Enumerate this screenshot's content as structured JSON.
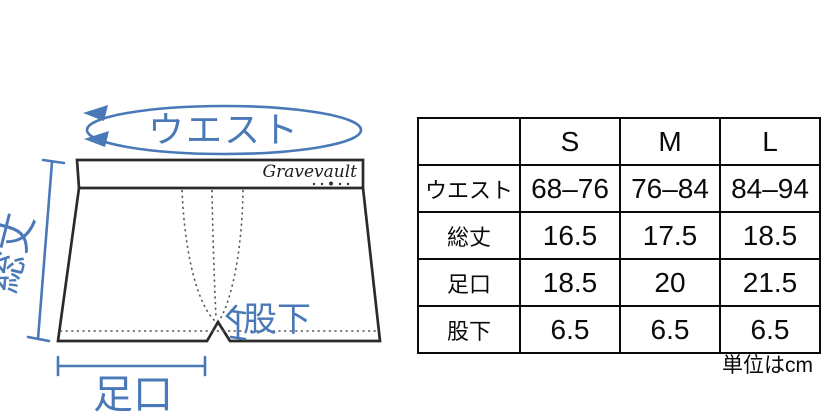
{
  "diagram": {
    "waist_label": "ウエスト",
    "total_length_label": "総丈",
    "leg_opening_label": "足口",
    "inseam_label": "股下",
    "brand_logo_text": "Gravevault",
    "accent_color": "#4a79b8",
    "outline_color": "#2b2b2b"
  },
  "size_table": {
    "columns": [
      "",
      "S",
      "M",
      "L"
    ],
    "rows": [
      {
        "label": "ウエスト",
        "values": [
          "68–76",
          "76–84",
          "84–94"
        ]
      },
      {
        "label": "総丈",
        "values": [
          "16.5",
          "17.5",
          "18.5"
        ]
      },
      {
        "label": "足口",
        "values": [
          "18.5",
          "20",
          "21.5"
        ]
      },
      {
        "label": "股下",
        "values": [
          "6.5",
          "6.5",
          "6.5"
        ]
      }
    ],
    "unit_note": "単位はcm"
  }
}
